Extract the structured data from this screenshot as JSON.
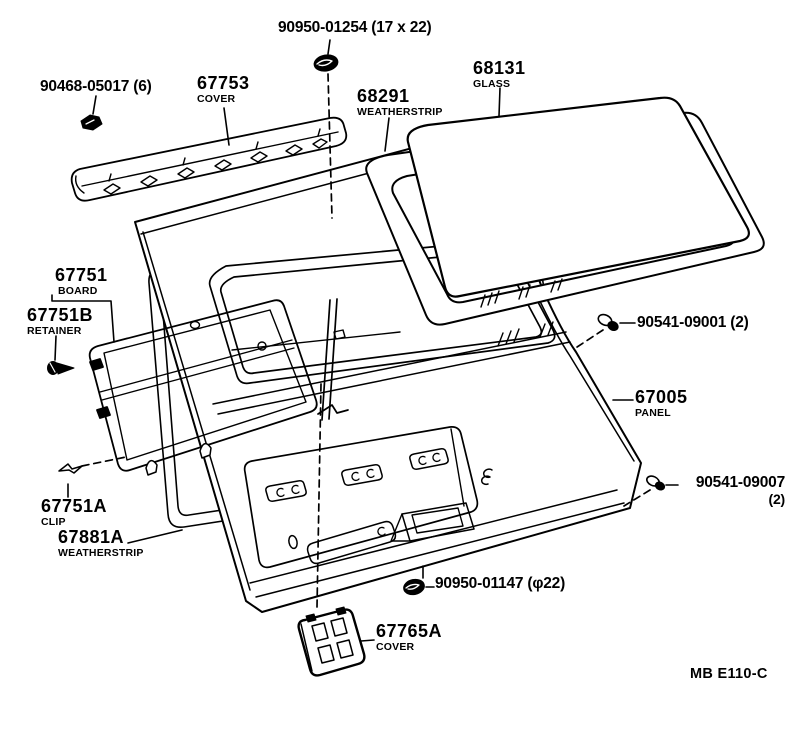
{
  "diagram_type": "exploded-parts-diagram",
  "subject": "back door / tailgate assembly",
  "footer": {
    "code": "MB E110-C"
  },
  "parts": {
    "grommet_top": {
      "number": "90950-01254 (17 x 22)"
    },
    "cover_clip": {
      "number": "90468-05017 (6)"
    },
    "cover": {
      "number": "67753",
      "name": "COVER"
    },
    "glass_weatherstrip": {
      "number": "68291",
      "name": "WEATHERSTRIP"
    },
    "glass": {
      "number": "68131",
      "name": "GLASS"
    },
    "board": {
      "number": "67751",
      "name": "BOARD"
    },
    "board_retainer": {
      "number": "67751B",
      "name": "RETAINER"
    },
    "grommet_right_upper": {
      "number": "90541-09001 (2)"
    },
    "panel": {
      "number": "67005",
      "name": "PANEL"
    },
    "grommet_right_lower": {
      "number": "90541-09007",
      "qty": "(2)"
    },
    "board_clip": {
      "number": "67751A",
      "name": "CLIP"
    },
    "door_weatherstrip": {
      "number": "67881A",
      "name": "WEATHERSTRIP"
    },
    "grommet_bottom": {
      "number": "90950-01147 (φ22)"
    },
    "cover_lower": {
      "number": "67765A",
      "name": "COVER"
    }
  }
}
